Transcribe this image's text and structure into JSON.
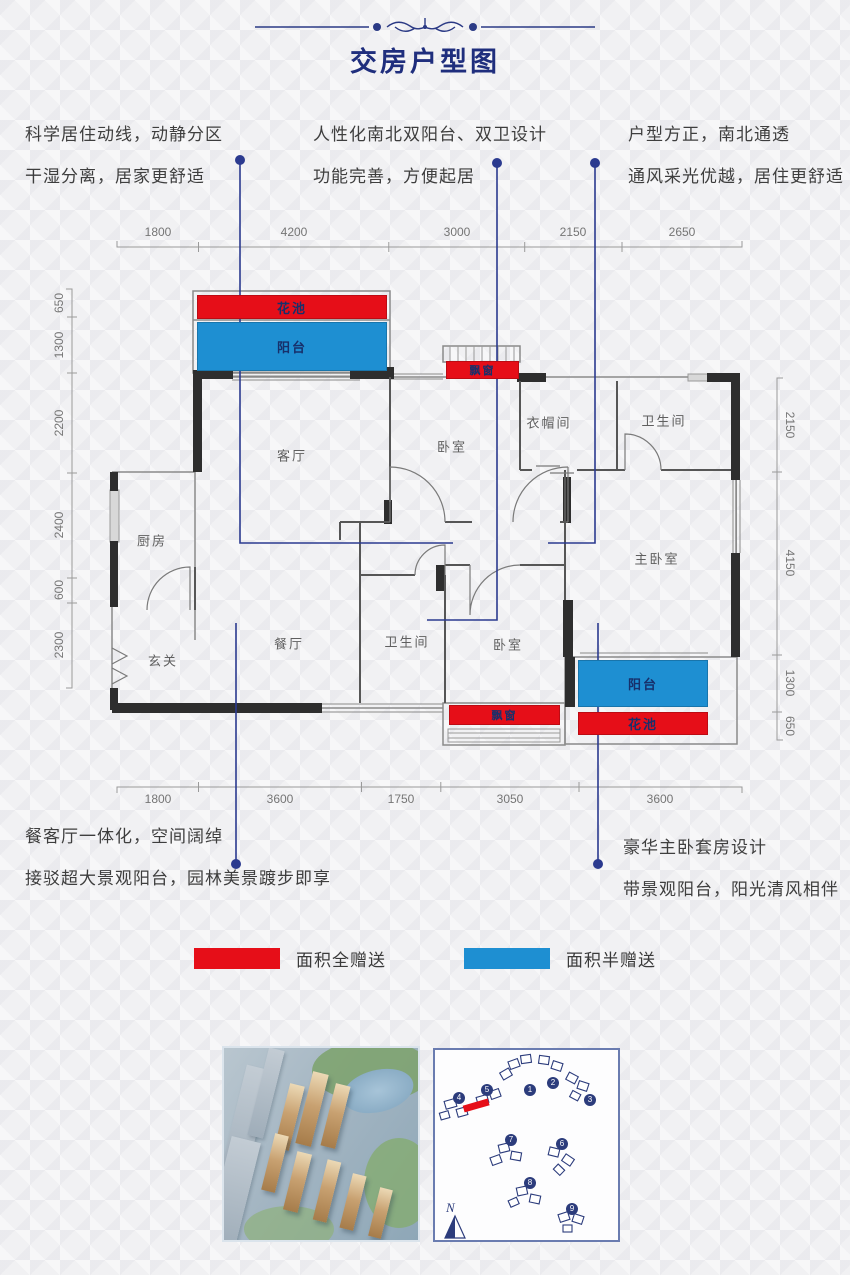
{
  "title": "交房户型图",
  "annotations": {
    "top_left": {
      "line1": "科学居住动线，动静分区",
      "line2": "干湿分离，居家更舒适"
    },
    "top_middle": {
      "line1": "人性化南北双阳台、双卫设计",
      "line2": "功能完善，方便起居"
    },
    "top_right": {
      "line1": "户型方正，南北通透",
      "line2": "通风采光优越，居住更舒适"
    },
    "bottom_left": {
      "line1": "餐客厅一体化，空间阔绰",
      "line2": "接驳超大景观阳台，园林美景踱步即享"
    },
    "bottom_right": {
      "line1": "豪华主卧套房设计",
      "line2": "带景观阳台，阳光清风相伴"
    }
  },
  "dimensions": {
    "top": [
      "1800",
      "4200",
      "3000",
      "2150",
      "2650"
    ],
    "bottom": [
      "1800",
      "3600",
      "1750",
      "3050",
      "3600"
    ],
    "left": [
      "650",
      "1300",
      "2200",
      "2400",
      "600",
      "2300"
    ],
    "right": [
      "2150",
      "4150",
      "1300",
      "650"
    ]
  },
  "rooms": {
    "living": "客厅",
    "bedroom_top": "卧室",
    "cloakroom": "衣帽间",
    "bath_top": "卫生间",
    "kitchen": "厨房",
    "foyer": "玄关",
    "dining": "餐厅",
    "bath_bottom": "卫生间",
    "bedroom_bottom": "卧室",
    "master": "主卧室",
    "flower_top": "花池",
    "balcony_top": "阳台",
    "baywin_top": "飘窗",
    "balcony_bottom": "阳台",
    "flower_bottom": "花池",
    "baywin_bottom": "飘窗"
  },
  "legend": [
    {
      "label": "面积全赠送",
      "color": "#e60e18"
    },
    {
      "label": "面积半赠送",
      "color": "#1e8fd2"
    }
  ],
  "siteplan": {
    "numbers": [
      "1",
      "2",
      "3",
      "4",
      "5",
      "6",
      "7",
      "8",
      "9"
    ],
    "compass": "N"
  },
  "colors": {
    "title_navy": "#1f2e7d",
    "leader_blue": "#2b3a8f",
    "gift_full_red": "#e60e18",
    "gift_half_blue": "#1e8fd2",
    "wall_black": "#2e2e2e"
  }
}
